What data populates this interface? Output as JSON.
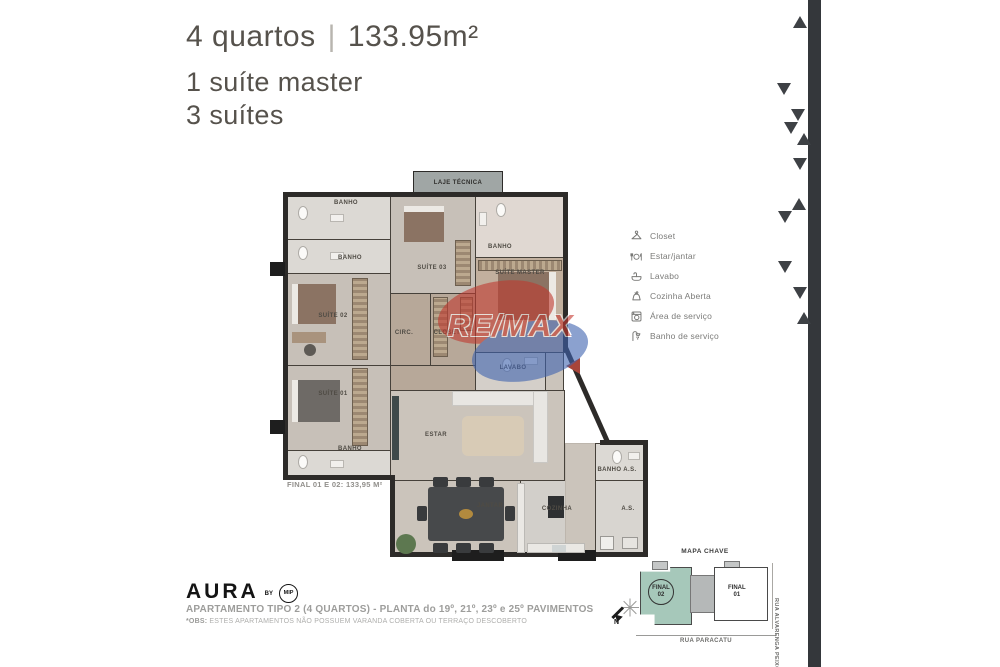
{
  "header": {
    "title_left": "4 quartos",
    "title_divider": "|",
    "title_right": "133.95m²",
    "subtitle_line1": "1 suíte master",
    "subtitle_line2": "3 suítes"
  },
  "legend": {
    "items": [
      {
        "icon": "hanger-icon",
        "label": "Closet"
      },
      {
        "icon": "dining-icon",
        "label": "Estar/jantar"
      },
      {
        "icon": "sink-icon",
        "label": "Lavabo"
      },
      {
        "icon": "kettle-icon",
        "label": "Cozinha Aberta"
      },
      {
        "icon": "washer-icon",
        "label": "Área de serviço"
      },
      {
        "icon": "shower-icon",
        "label": "Banho de serviço"
      }
    ]
  },
  "plan": {
    "labels": {
      "laje_tecnica": "LAJE TÉCNICA",
      "banho": "BANHO",
      "suite_03": "SUÍTE 03",
      "suite_master": "SUÍTE MASTER",
      "suite_02": "SUÍTE 02",
      "suite_01": "SUÍTE 01",
      "circ": "CIRC.",
      "closet": "CLOSET",
      "lavabo": "LAVABO",
      "estar": "ESTAR",
      "jantar": "JANTAR",
      "cozinha": "COZINHA",
      "banho_as": "BANHO A.S.",
      "as": "A.S."
    },
    "area_note": "FINAL 01 E 02: 133,95 M²",
    "watermark": "RE/MAX"
  },
  "footer": {
    "brand": "AURA",
    "brand_by": "BY",
    "brand_mip": "MIP",
    "line1": "APARTAMENTO TIPO 2 (4 QUARTOS) - PLANTA do 19º, 21º, 23º e 25º PAVIMENTOS",
    "obs_label": "*OBS:",
    "obs_text": " ESTES APARTAMENTOS NÃO POSSUEM VARANDA COBERTA OU TERRAÇO DESCOBERTO"
  },
  "map_key": {
    "title": "MAPA CHAVE",
    "unit_left_line1": "FINAL",
    "unit_left_line2": "02",
    "unit_right_line1": "FINAL",
    "unit_right_line2": "01",
    "street_bottom": "RUA PARACATU",
    "street_right": "RUA ALVARENGA PEIXOTO",
    "compass_label": "N"
  },
  "colors": {
    "wall": "#2d2b29",
    "accent_red": "#a8453a",
    "map_unit_highlight": "#a6c8ba",
    "side_bar": "#34373b"
  }
}
